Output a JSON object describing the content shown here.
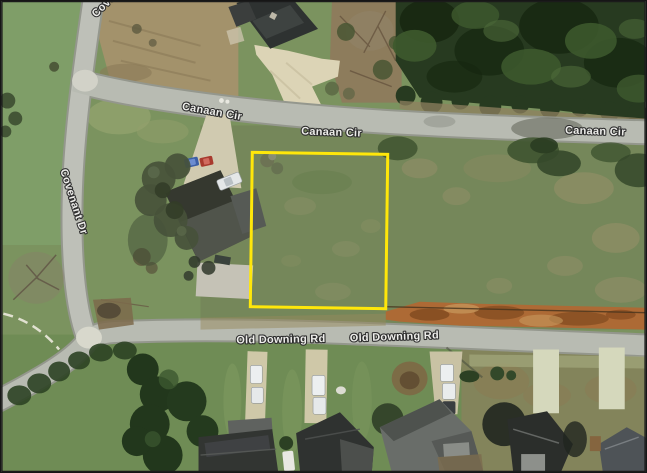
{
  "map": {
    "view": "aerial-satellite",
    "streets": {
      "canaan_cir": "Canaan Cir",
      "covenant_dr": "Covenant Dr",
      "old_downing_rd": "Old Downing Rd"
    },
    "labels": [
      {
        "id": "canaan-cir-1",
        "text": "Canaan Cir"
      },
      {
        "id": "canaan-cir-2",
        "text": "Canaan Cir"
      },
      {
        "id": "canaan-cir-3",
        "text": "Canaan Cir"
      },
      {
        "id": "covenant-dr-top",
        "text": "Covenant Dr"
      },
      {
        "id": "covenant-dr-left",
        "text": "Covenant Dr"
      },
      {
        "id": "old-downing-1",
        "text": "Old Downing Rd"
      },
      {
        "id": "old-downing-2",
        "text": "Old Downing Rd"
      }
    ],
    "parcel": {
      "shape": "rectangle",
      "outline_color": "#ffe70a"
    },
    "colors": {
      "parcel_outline": "#ffe70a",
      "road": "#b8bbb2",
      "road_edge": "#94978d",
      "grass": "#7b935f",
      "lawn": "#6f8c55",
      "forest": "#273a20",
      "dirt_brown": "#a3926b",
      "autumn_strip": "#ad6a35",
      "label_text": "#ededea",
      "label_halo": "#2e2e2e"
    }
  }
}
